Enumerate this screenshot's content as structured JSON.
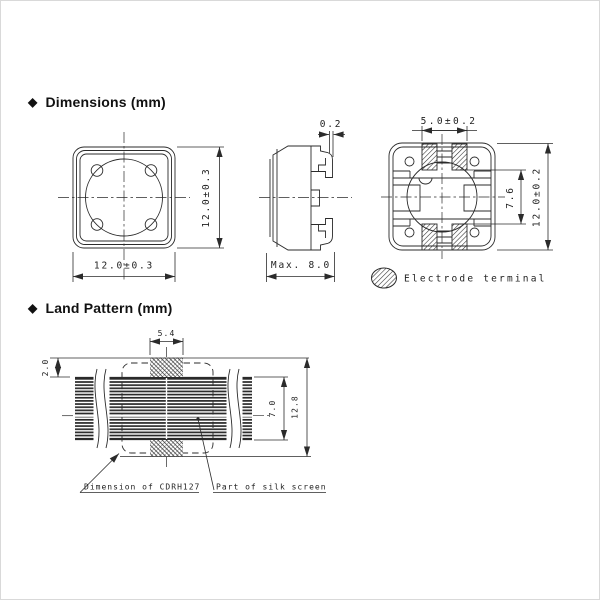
{
  "headings": {
    "bullet": "◆",
    "dimensions": "Dimensions (mm)",
    "land_pattern": "Land Pattern (mm)"
  },
  "front_view": {
    "width_dim": "12.0±0.3",
    "height_dim": "12.0±0.3"
  },
  "side_view": {
    "terminal_gap_dim": "0.2",
    "width_dim": "Max. 8.0"
  },
  "bottom_view": {
    "terminal_span_dim": "5.0±0.2",
    "terminal_inner_gap_dim": "7.6",
    "height_dim": "12.0±0.2"
  },
  "legend": {
    "electrode_terminal": "Electrode terminal"
  },
  "land_pattern": {
    "pad_width_dim": "5.4",
    "pad_height_dim": "2.0",
    "silk_height_dim": "7.0",
    "overall_height_dim": "12.8",
    "component_outline_label": "Dimension of CDRH127",
    "silk_screen_label": "Part of silk screen"
  },
  "colors": {
    "line": "#2b2b2b",
    "text": "#1f1f1f",
    "background": "#ffffff"
  }
}
